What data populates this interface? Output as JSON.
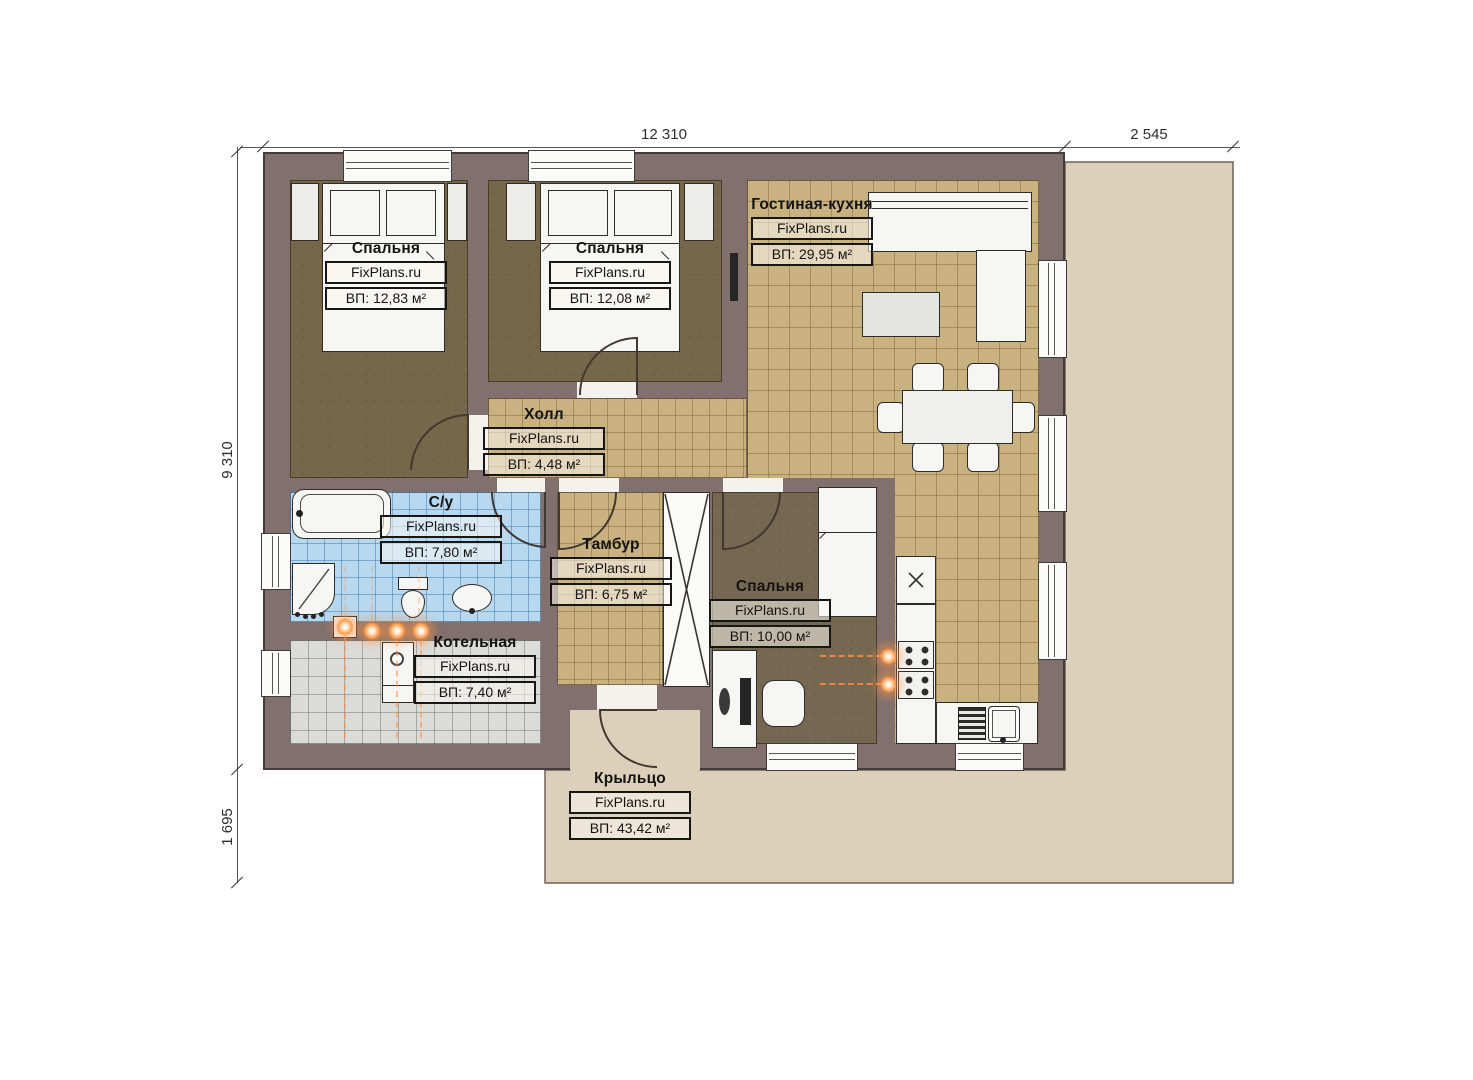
{
  "dims": {
    "top_main": "12 310",
    "top_right": "2 545",
    "left_main": "9 310",
    "left_bottom": "1 695"
  },
  "rooms": [
    {
      "id": "bedroom1",
      "name": "Спальня",
      "brand": "FixPlans.ru",
      "area": "ВП: 12,83 м²"
    },
    {
      "id": "bedroom2",
      "name": "Спальня",
      "brand": "FixPlans.ru",
      "area": "ВП: 12,08 м²"
    },
    {
      "id": "living_kitchen",
      "name": "Гостиная-кухня",
      "brand": "FixPlans.ru",
      "area": "ВП: 29,95 м²"
    },
    {
      "id": "hall",
      "name": "Холл",
      "brand": "FixPlans.ru",
      "area": "ВП: 4,48 м²"
    },
    {
      "id": "bathroom",
      "name": "С/у",
      "brand": "FixPlans.ru",
      "area": "ВП: 7,80 м²"
    },
    {
      "id": "tambour",
      "name": "Тамбур",
      "brand": "FixPlans.ru",
      "area": "ВП: 6,75 м²"
    },
    {
      "id": "bedroom3",
      "name": "Спальня",
      "brand": "FixPlans.ru",
      "area": "ВП: 10,00 м²"
    },
    {
      "id": "boiler",
      "name": "Котельная",
      "brand": "FixPlans.ru",
      "area": "ВП: 7,40 м²"
    },
    {
      "id": "porch",
      "name": "Крыльцо",
      "brand": "FixPlans.ru",
      "area": "ВП: 43,42 м²"
    }
  ],
  "colors": {
    "wall": "#81706e",
    "floor_tan": "#c9b280",
    "floor_brown": "#77674a",
    "floor_blue": "#b7d8ef",
    "floor_gray": "#dbdbd9",
    "terrace": "#ddd0ba",
    "accent_orange": "#ff8c3f"
  }
}
